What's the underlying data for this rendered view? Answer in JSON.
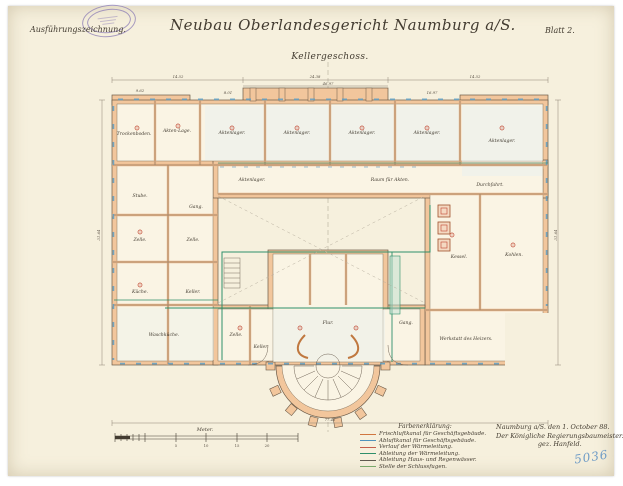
{
  "colors": {
    "paper": "#f6f0dd",
    "wall": "#f2c69c",
    "wall_edge": "#c0783f",
    "ink": "#433c31",
    "line": "#6e6254",
    "dim": "#8d8375",
    "window_blue": "#5f9fc4",
    "pipe_green": "#2e8f6a",
    "marker_red": "#c0452f",
    "stamp_purple": "#8b7cb5",
    "number_blue": "#6f9cc6"
  },
  "header": {
    "annotation": "Ausführungszeichnung.",
    "title": "Neubau Oberlandesgericht Naumburg a/S.",
    "sheet": "Blatt 2.",
    "subtitle": "Kellergeschoss."
  },
  "plan": {
    "rooms": [
      {
        "label": "Trockenboden."
      },
      {
        "label": "Akten-Lage."
      },
      {
        "label": "Aktenlager."
      },
      {
        "label": "Aktenlager."
      },
      {
        "label": "Aktenlager."
      },
      {
        "label": "Aktenlager."
      },
      {
        "label": "Aktenlager."
      },
      {
        "label": "Raum für Akten."
      },
      {
        "label": "Aktenlager."
      },
      {
        "label": "Stube."
      },
      {
        "label": "Zelle."
      },
      {
        "label": "Zelle."
      },
      {
        "label": "Küche."
      },
      {
        "label": "Keller."
      },
      {
        "label": "Waschküche."
      },
      {
        "label": "Gang."
      },
      {
        "label": "Durchfahrt."
      },
      {
        "label": "Kessel."
      },
      {
        "label": "Kohlen."
      },
      {
        "label": "Werkstatt des Heizers."
      },
      {
        "label": "Zelle."
      },
      {
        "label": "Keller."
      },
      {
        "label": "Flur."
      },
      {
        "label": "Gang."
      }
    ],
    "dims": [
      "14.52",
      "24.38",
      "14.52",
      "46.97",
      "77.45",
      "31.64",
      "31.64",
      "8.01",
      "16.97",
      "9.62"
    ]
  },
  "scalebar": {
    "label": "Meter.",
    "ticks": [
      "5",
      "10",
      "15",
      "20"
    ]
  },
  "legend": {
    "title": "Farbenerklärung:",
    "items": [
      {
        "label": "Frischluftkanal für Geschäftsgebäude.",
        "color": "#d0763f"
      },
      {
        "label": "Abluftkanal für Geschäftsgebäude.",
        "color": "#4f94bd"
      },
      {
        "label": "Verlauf der Wärmeleitung.",
        "color": "#c45f4c"
      },
      {
        "label": "Ableitung der Wärmeleitung.",
        "color": "#2e8f6a"
      },
      {
        "label": "Ableitung Haus- und Regenwässer.",
        "color": "#5f5a50"
      },
      {
        "label": "Stelle der Schlussfugen.",
        "color": "#79a96b"
      }
    ]
  },
  "signature": {
    "line1": "Naumburg a/S. den 1. October 88.",
    "line2": "Der Königliche Regierungsbaumeister.",
    "line3": "gez. Hanfeld."
  },
  "inventory_number": "5036"
}
